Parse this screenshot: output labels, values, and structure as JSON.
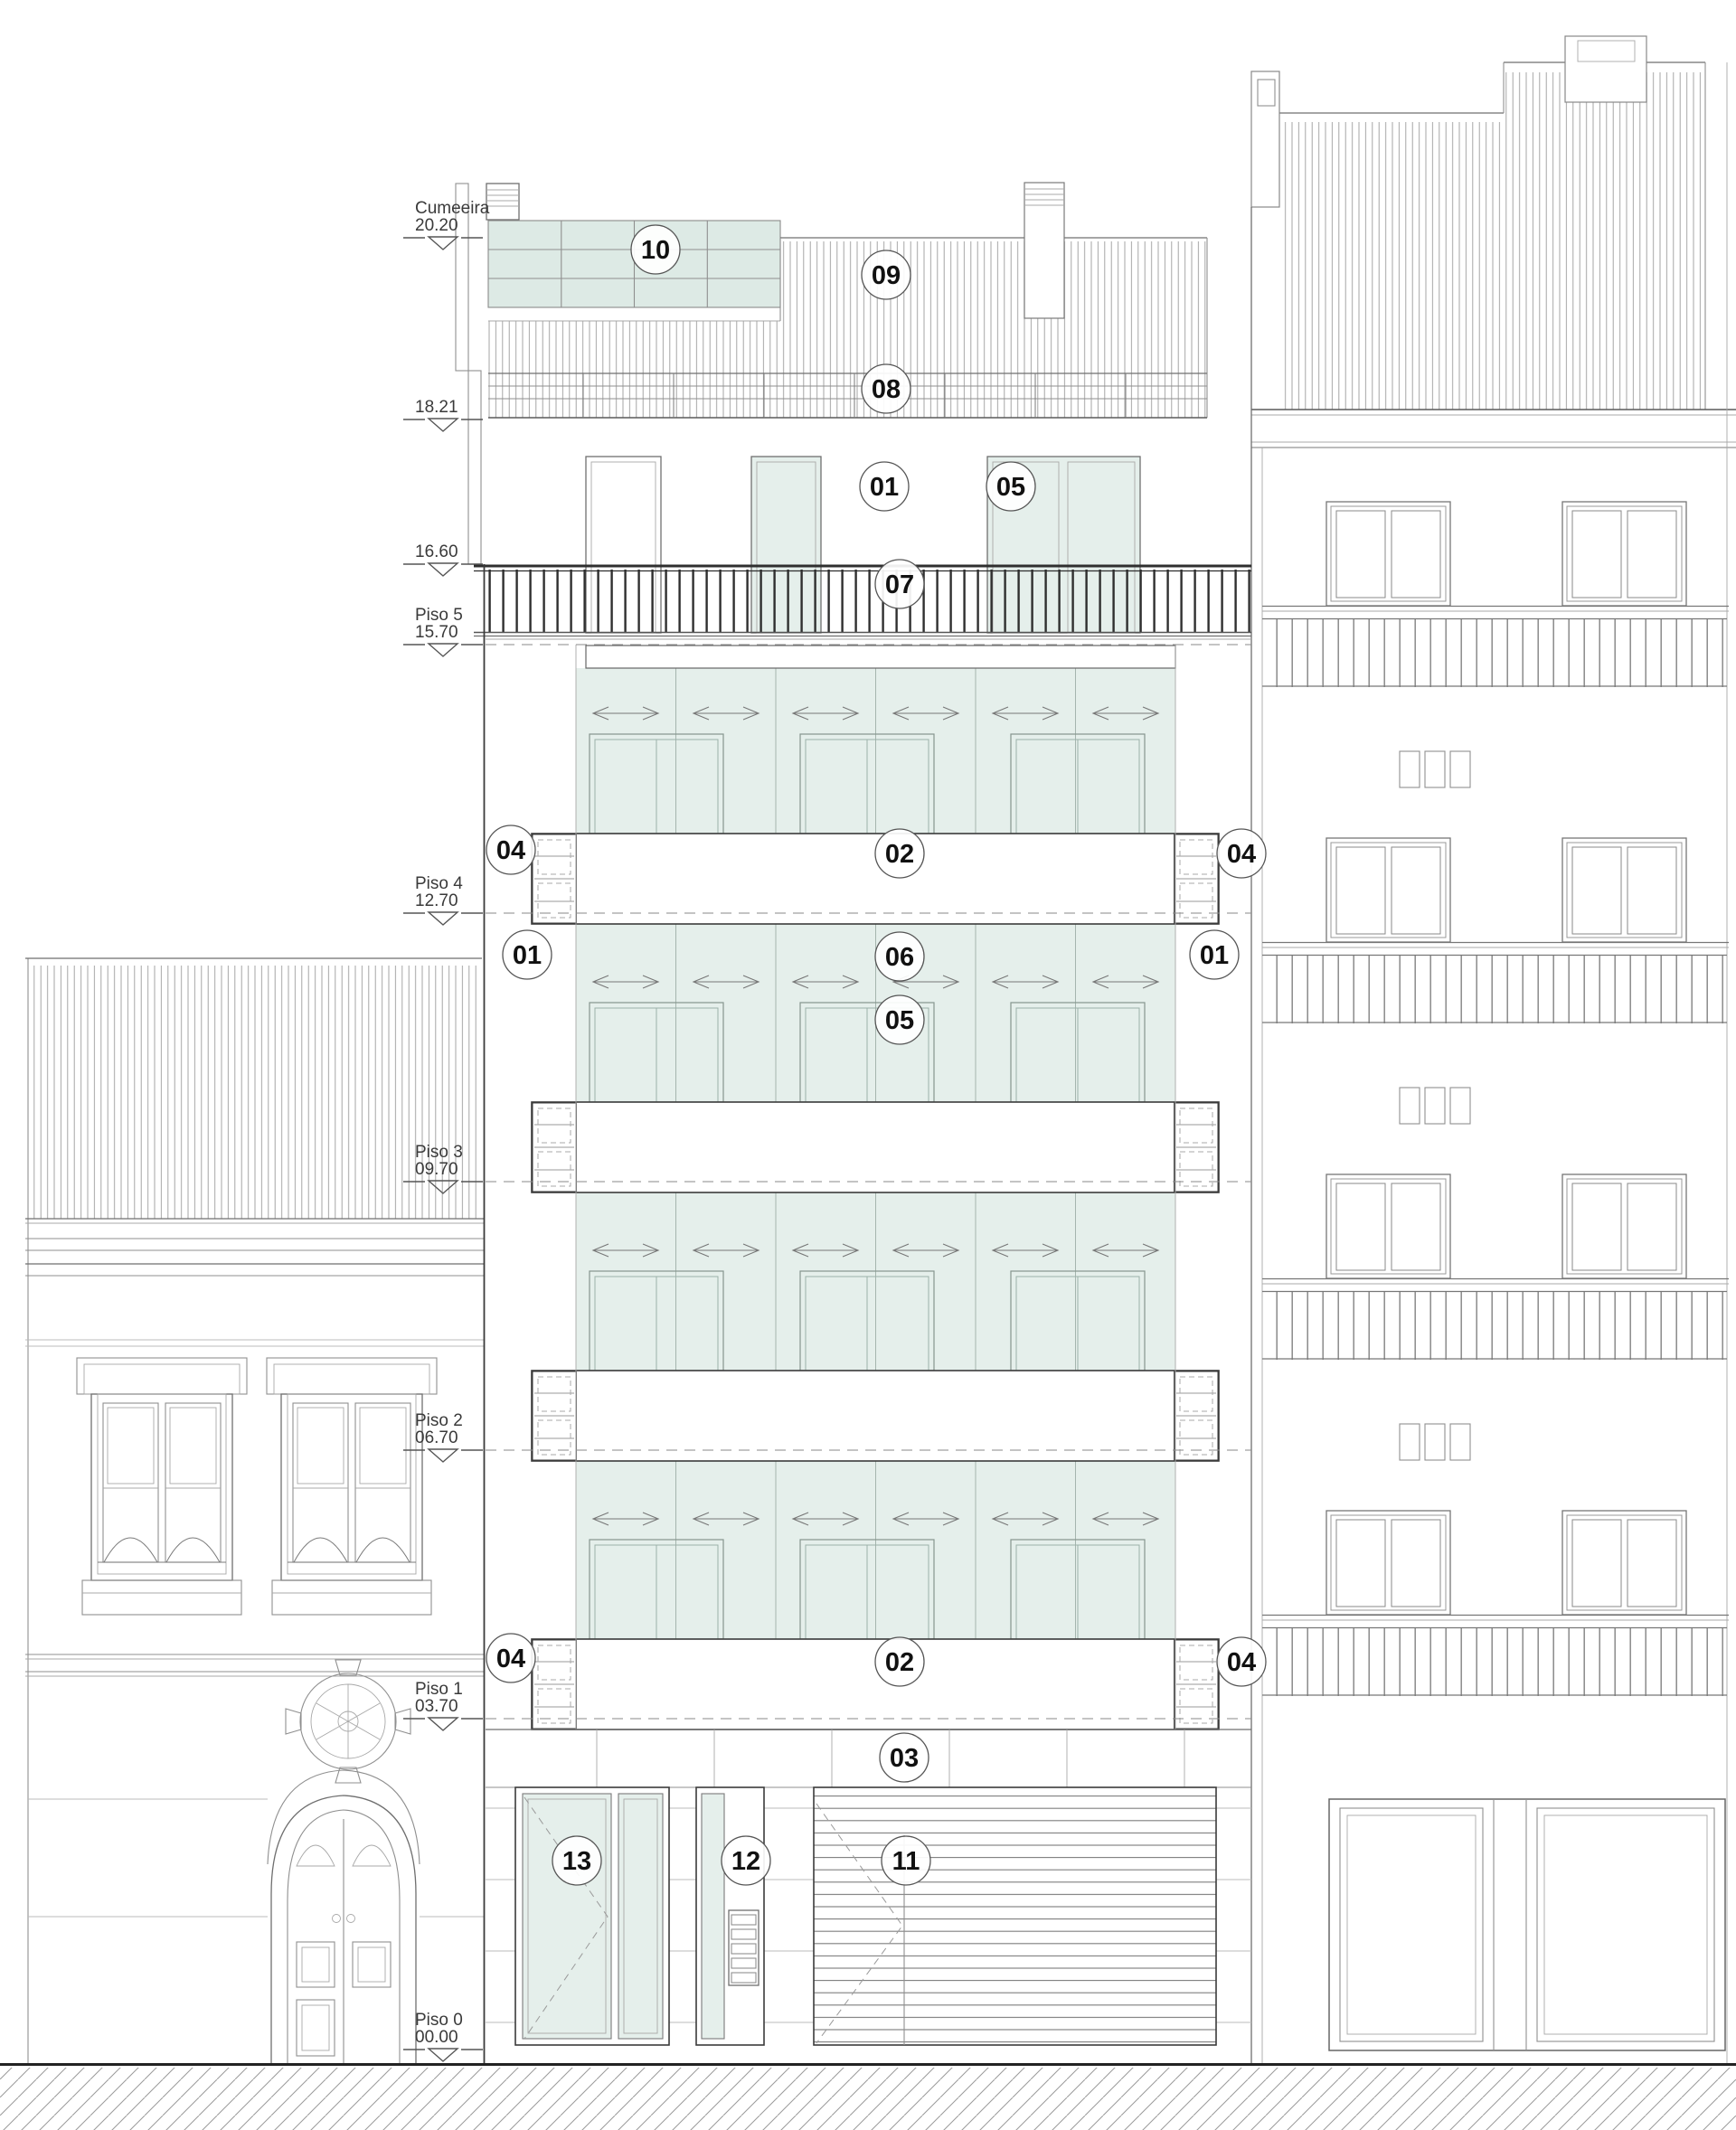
{
  "drawing_type": "architectural-elevation",
  "levels": [
    {
      "name": "Cumeeira",
      "elevation": "20.20"
    },
    {
      "name": "",
      "elevation": "18.21"
    },
    {
      "name": "",
      "elevation": "16.60"
    },
    {
      "name": "Piso 5",
      "elevation": "15.70"
    },
    {
      "name": "Piso 4",
      "elevation": "12.70"
    },
    {
      "name": "Piso 3",
      "elevation": "09.70"
    },
    {
      "name": "Piso 2",
      "elevation": "06.70"
    },
    {
      "name": "Piso 1",
      "elevation": "03.70"
    },
    {
      "name": "Piso 0",
      "elevation": "00.00"
    }
  ],
  "callouts": [
    {
      "value": "10"
    },
    {
      "value": "09"
    },
    {
      "value": "08"
    },
    {
      "value": "01"
    },
    {
      "value": "05"
    },
    {
      "value": "07"
    },
    {
      "value": "04"
    },
    {
      "value": "02"
    },
    {
      "value": "04"
    },
    {
      "value": "01"
    },
    {
      "value": "06"
    },
    {
      "value": "05"
    },
    {
      "value": "01"
    },
    {
      "value": "04"
    },
    {
      "value": "02"
    },
    {
      "value": "04"
    },
    {
      "value": "03"
    },
    {
      "value": "13"
    },
    {
      "value": "12"
    },
    {
      "value": "11"
    }
  ],
  "colors": {
    "glass": "#e5efeb",
    "solar_panels": "#ddeae5",
    "line_light": "#9b9b9b",
    "line_mid": "#6f6f6f",
    "line_dark": "#3b3b3b",
    "railing_dark": "#2f2f2f",
    "background": "#ffffff"
  }
}
